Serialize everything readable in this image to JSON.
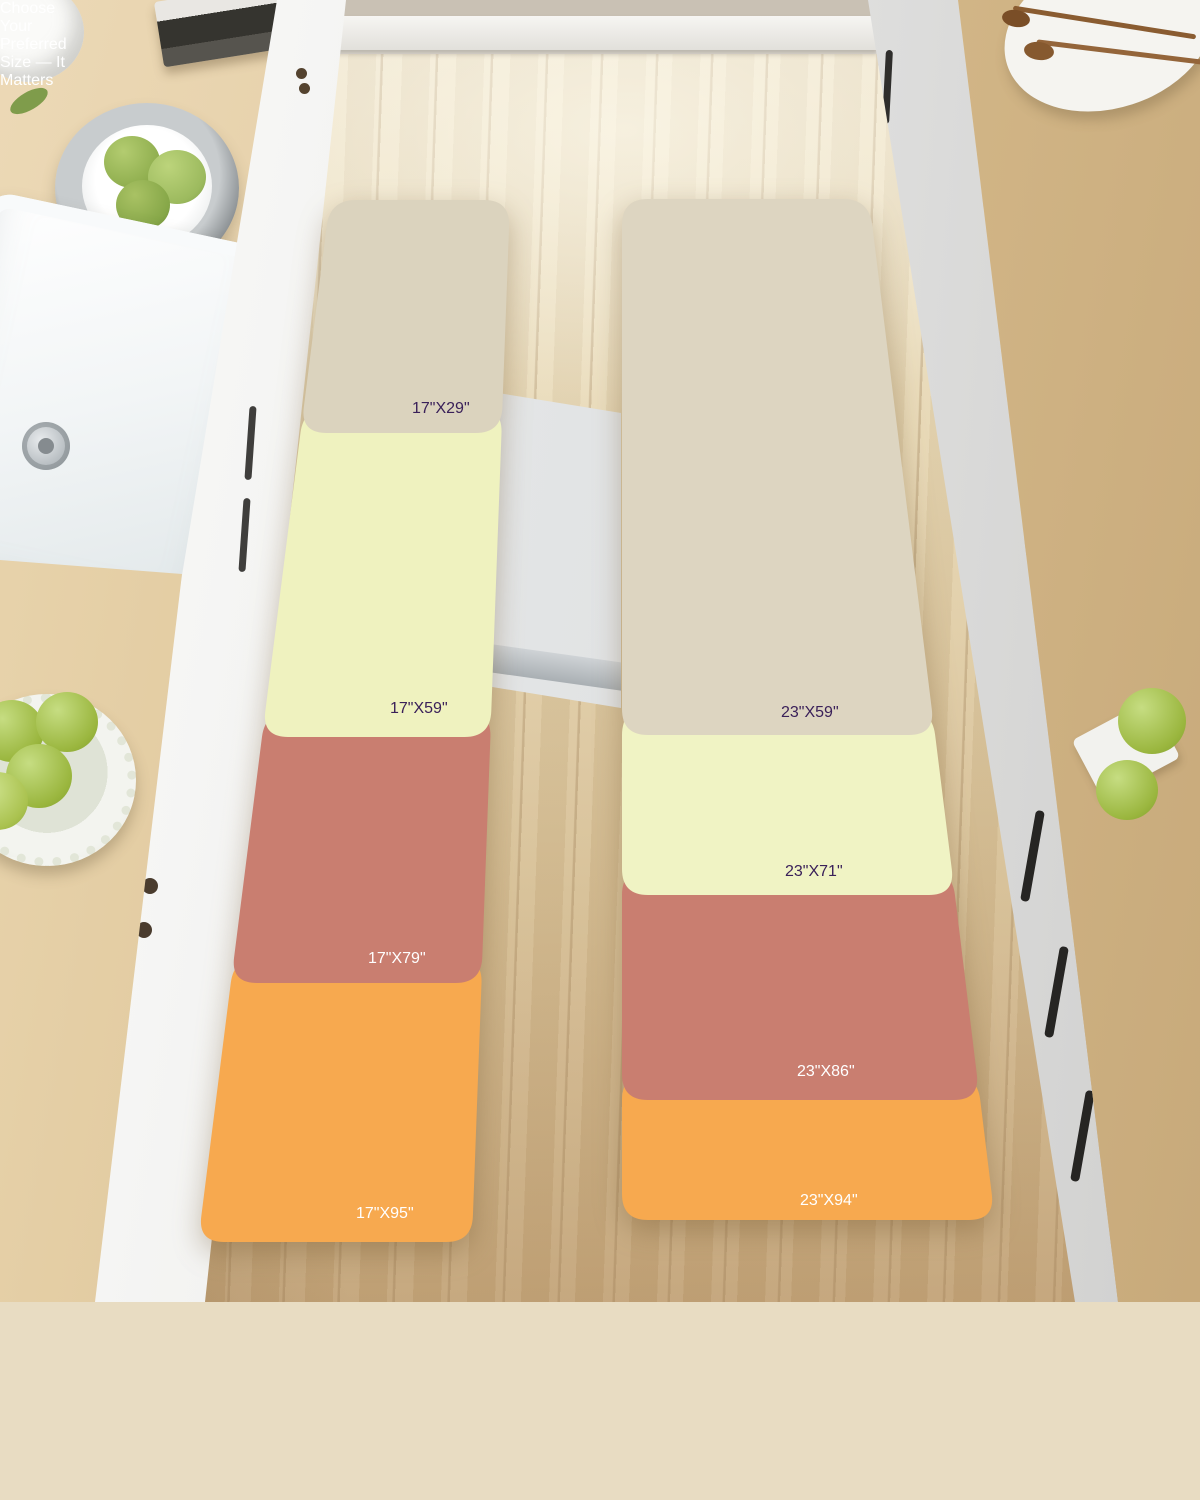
{
  "runners": {
    "left": {
      "sizes": [
        {
          "label": "17\"X29\"",
          "color": "#DBD3BE",
          "text_color": "#3A2059"
        },
        {
          "label": "17\"X59\"",
          "color": "#EFF2BF",
          "text_color": "#3A2059"
        },
        {
          "label": "17\"X79\"",
          "color": "#C97E70",
          "text_color": "#FFFFFF"
        },
        {
          "label": "17\"X95\"",
          "color": "#F7A94F",
          "text_color": "#FFFFFF"
        }
      ]
    },
    "right": {
      "sizes": [
        {
          "label": "23\"X59\"",
          "color": "#DDD5C1",
          "text_color": "#3A2059"
        },
        {
          "label": "23\"X71\"",
          "color": "#F0F3C4",
          "text_color": "#3A2059"
        },
        {
          "label": "23\"X86\"",
          "color": "#C97E70",
          "text_color": "#FFFFFF"
        },
        {
          "label": "23\"X94\"",
          "color": "#F7A94F",
          "text_color": "#FFFFFF"
        }
      ]
    }
  },
  "banner": {
    "text": "Choose Your Preferred Size — It Matters",
    "background_color": "#4B2A60",
    "text_color": "#FFFFFF",
    "icon": "warning-triangle-icon",
    "icon_fill": "#ECB94D",
    "icon_border": "#FFFFFF",
    "icon_mark_color": "#3A3A3C"
  }
}
